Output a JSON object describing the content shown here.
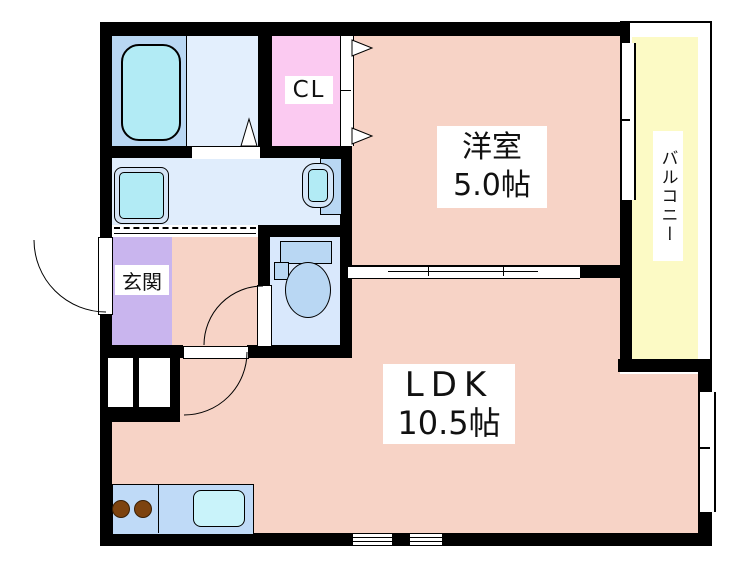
{
  "plan": {
    "western_room": {
      "name": "洋室",
      "size": "5.0帖"
    },
    "ldk": {
      "name": "LDK",
      "size": "10.5帖"
    },
    "closet_label": "CL",
    "entrance_label": "玄関",
    "balcony_label": "バルコニー"
  },
  "colors": {
    "wall": "#000000",
    "room_pink": "#f7d3c6",
    "closet_pink": "#fbcaf1",
    "entrance_purple": "#c9b5ee",
    "balcony_yellow": "#fcfac5",
    "bath_blue": "#b9d7f3",
    "wet_area_blue": "#e0edfc",
    "toilet_blue": "#d9e8fc",
    "kitchen_blue": "#bfdaf7",
    "fixture_cyan": "#b2ebf5",
    "burner_brown": "#7d430f"
  }
}
